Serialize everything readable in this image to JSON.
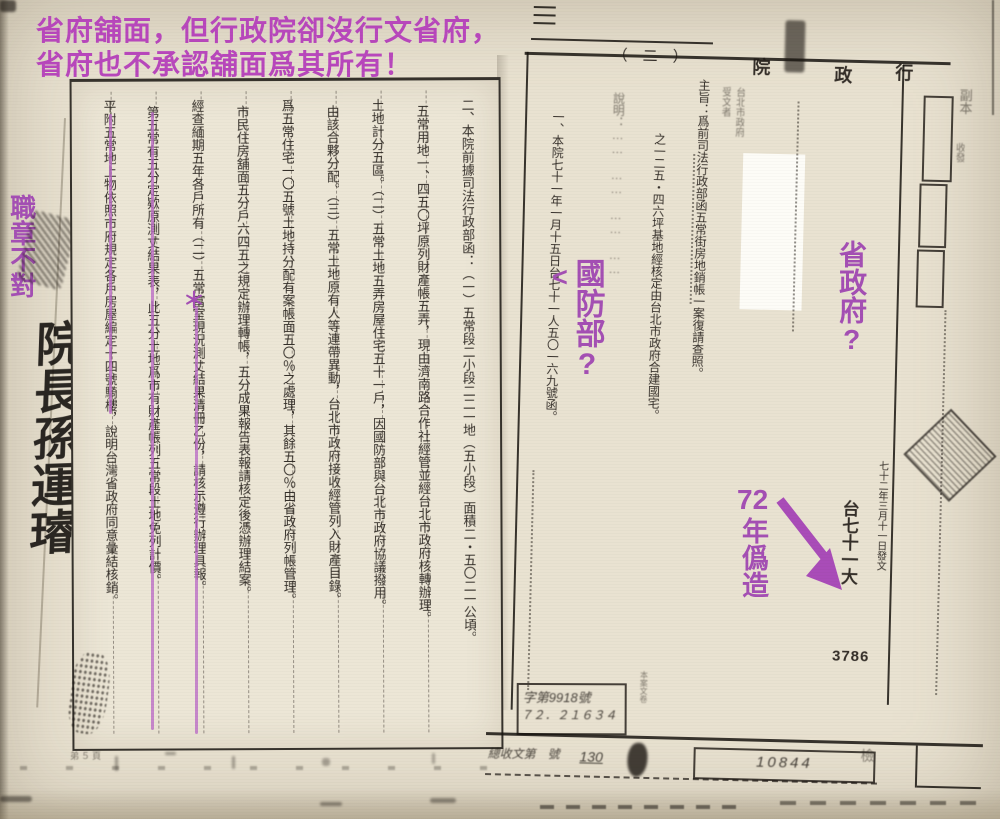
{
  "colors": {
    "accent_magenta": "#b847bc",
    "accent_purple": "#a44fb4",
    "highlight_line": "#bb6cc6",
    "ink": "#201b16",
    "paper": "#e9e2d1"
  },
  "annotations": {
    "heading_line1": "省府舖面，但行政院卻沒行文省府，",
    "heading_line2": "省府也不承認舖面爲其所有！",
    "seal_note": "職章不對",
    "defense_arrow": "<",
    "defense_ministry": "國防部?",
    "provincial_gov": "省政府?",
    "forgery_num": "72",
    "forgery_text": "年僞造",
    "star_mark": "＊"
  },
  "handwriting": {
    "premier_signature": "院長孫運璿"
  },
  "left_document": {
    "columns": [
      "二、本院前據司法行政部函：（一）五常段二小段二二一地（五小段）面積二・五〇二一公頃。",
      "五常用地一、四五〇坪原列財產帳五弄，現由濟南路合作社經管並經台北市政府核轉辦理。",
      "土地計分五區。（二）五常土地五弄房屋住宅五十一戶，因國防部與台北市政府協議撥用。",
      "由該合夥分配。（三）五常土地原有人等連帶異動，台北市政府接收經管列入財產目錄。",
      "爲五常住宅一〇五號土地持分配有案帳面五〇％之處理，其餘五〇％由省政府列帳管理。",
      "市民住房舖面五分戶六四五之規定辦理轉帳，五分成果報告表報請核定後憑辦理結案。",
      "經查緬期五年各戶所有（二）五常富室現況測丈結果清冊乙份，請核示遵行辦理具報。",
      "第五常有五分定欵原測丈結果表，此五分土地爲市有財產帳列五常段土地免列計價。",
      "平附五常地上物依照市府規定各戶房屋編定十四號騎樓，說明台灣省政府同意彙結核銷。"
    ],
    "footer_note": "弟５頁"
  },
  "right_document": {
    "agency_char_1": "行",
    "agency_char_2": "政",
    "agency_char_3": "院",
    "page_marker": "（　二　）",
    "recipient_label": "受文者",
    "recipient_value": "台北市政府",
    "margin_label_1": "副本",
    "margin_label_2": "收發",
    "columns": [
      "主旨：爲前司法行政部函五常街房地銷帳一案復請查照。",
      "之一二五・四六坪基地經核定由台北市政府合建國宅。",
      "說明：……　……　……　……",
      "一、本院七十一年一月十五日台七十一人五〇一六九號函。"
    ],
    "tiny_column": "本案文卷",
    "date_line": "七十二年三月十一日發文",
    "ref_column": "台七十一大",
    "ref_number": "3786",
    "stamp_box_line1": "字第9918號",
    "stamp_box_line2": "７２．２１６３４",
    "bottom_left_scribble": "總收文第　號",
    "receipt_number": "130",
    "dispatch_stamp": "10844",
    "corner_stamp": "檢"
  }
}
